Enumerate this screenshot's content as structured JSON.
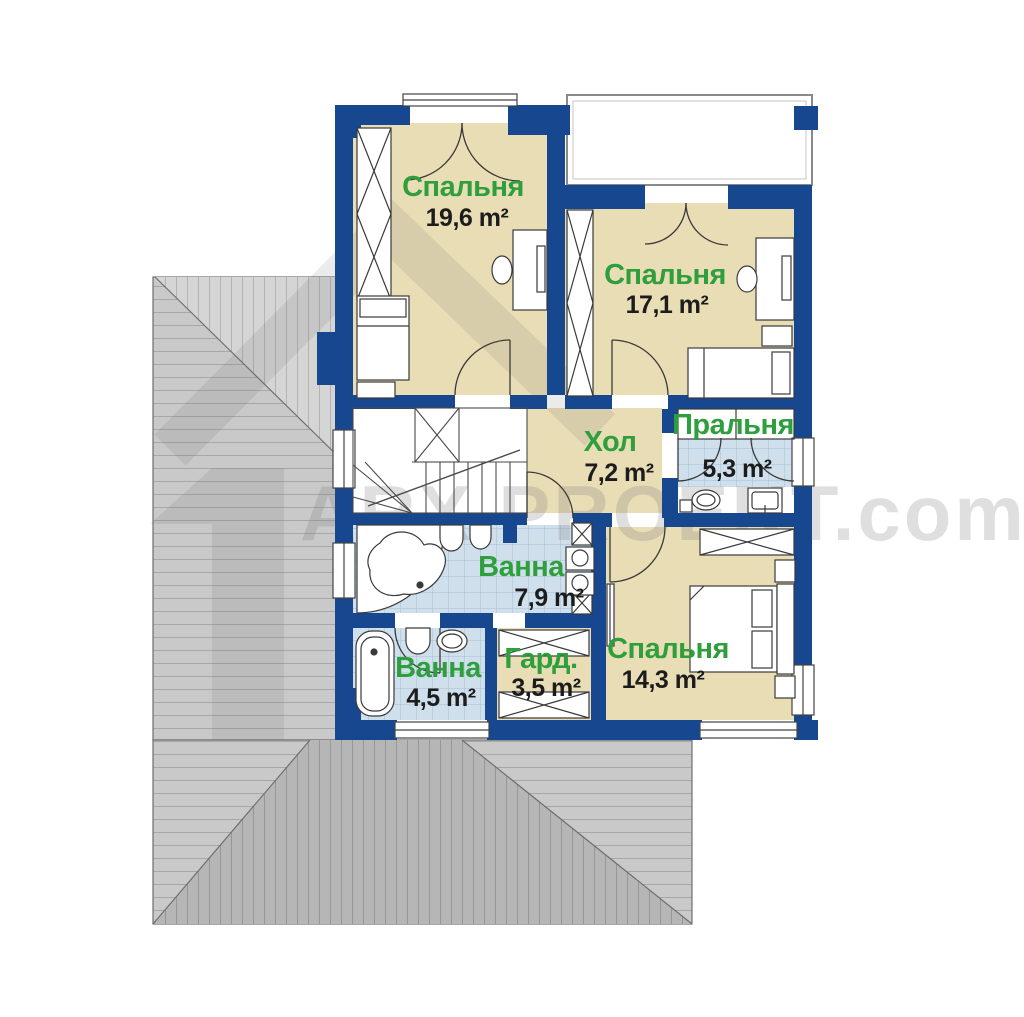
{
  "watermark": {
    "brand": "ARX PROEKT.com"
  },
  "rooms": [
    {
      "id": "bedroom-1",
      "name": "Спальня",
      "area": "19,6 m²"
    },
    {
      "id": "bedroom-2",
      "name": "Спальня",
      "area": "17,1 m²"
    },
    {
      "id": "hall",
      "name": "Хол",
      "area": "7,2 m²"
    },
    {
      "id": "laundry",
      "name": "Пральня",
      "area": "5,3 m²"
    },
    {
      "id": "bathroom-1",
      "name": "Ванна",
      "area": "7,9 m²"
    },
    {
      "id": "bathroom-2",
      "name": "Ванна",
      "area": "4,5 m²"
    },
    {
      "id": "wardrobe",
      "name": "Гард.",
      "area": "3,5 m²"
    },
    {
      "id": "bedroom-3",
      "name": "Спальня",
      "area": "14,3 m²"
    }
  ],
  "colors": {
    "wall": "#17478e",
    "floor": "#e9ddb6",
    "tile": "#cfe0ec",
    "roof_light": "#cacaca",
    "roof_dark": "#b6b6b6",
    "label_green": "#2f9e3c",
    "area_text": "#1c1c1c"
  }
}
